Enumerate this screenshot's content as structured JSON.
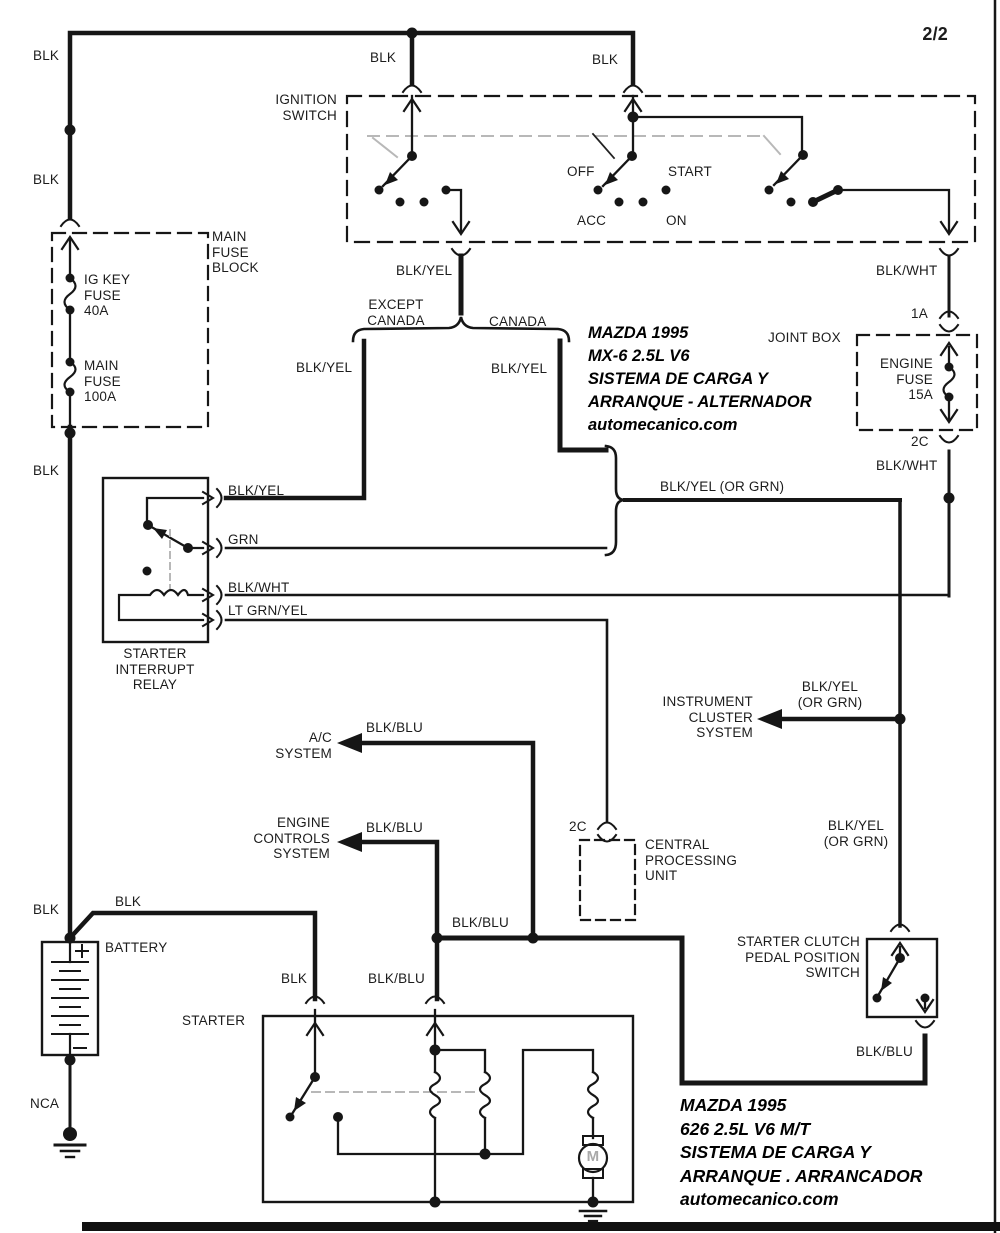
{
  "page": {
    "sheet": "2/2"
  },
  "blocks": {
    "ignition_switch": "IGNITION\nSWITCH",
    "main_fuse_block": "MAIN\nFUSE\nBLOCK",
    "ig_key_fuse": "IG KEY\nFUSE\n40A",
    "main_fuse": "MAIN\nFUSE\n100A",
    "joint_box": "JOINT BOX",
    "engine_fuse": "ENGINE\nFUSE\n15A",
    "starter_interrupt_relay": "STARTER\nINTERRUPT\nRELAY",
    "instrument_cluster_system": "INSTRUMENT\nCLUSTER\nSYSTEM",
    "ac_system": "A/C\nSYSTEM",
    "engine_controls_system": "ENGINE\nCONTROLS\nSYSTEM",
    "central_processing_unit": "CENTRAL\nPROCESSING\nUNIT",
    "battery": "BATTERY",
    "starter": "STARTER",
    "starter_clutch_switch": "STARTER CLUTCH\nPEDAL POSITION\nSWITCH",
    "motor_label": "M"
  },
  "ignition_positions": {
    "off": "OFF",
    "acc": "ACC",
    "start": "START",
    "on": "ON"
  },
  "connector_ids": {
    "c1a": "1A",
    "c2c_joint": "2C",
    "c2c_cpu": "2C"
  },
  "annotations": {
    "except_canada": "EXCEPT\nCANADA",
    "canada": "CANADA"
  },
  "wire_labels": {
    "blk_top_left": "BLK",
    "blk_left_upper": "BLK",
    "blk_left_lower": "BLK",
    "blk_left_bottom": "BLK",
    "blk_top_mid": "BLK",
    "blk_top_right": "BLK",
    "blk_yel_ignition": "BLK/YEL",
    "blk_wht_ignition": "BLK/WHT",
    "blk_yel_left_branch": "BLK/YEL",
    "blk_yel_right_branch": "BLK/YEL",
    "relay_pin_blk_yel": "BLK/YEL",
    "relay_pin_grn": "GRN",
    "relay_pin_blk_wht": "BLK/WHT",
    "relay_pin_lt_grn_yel": "LT GRN/YEL",
    "blk_yel_or_grn_main": "BLK/YEL (OR GRN)",
    "blk_wht_joint_lower": "BLK/WHT",
    "blk_yel_or_grn_cluster": "BLK/YEL\n(OR GRN)",
    "blk_yel_or_grn_switch": "BLK/YEL\n(OR GRN)",
    "blk_blu_ac": "BLK/BLU",
    "blk_blu_engine": "BLK/BLU",
    "blk_blu_bus": "BLK/BLU",
    "blk_blu_starter": "BLK/BLU",
    "blk_blu_clutch": "BLK/BLU",
    "blk_battery_feed": "BLK",
    "blk_battery_starter": "BLK",
    "nca": "NCA"
  },
  "title_block_top": {
    "line1": "MAZDA 1995",
    "line2": "MX-6  2.5L  V6",
    "line3": "SISTEMA DE CARGA Y",
    "line4": "ARRANQUE  - ALTERNADOR",
    "line5": "automecanico.com"
  },
  "title_block_bottom": {
    "line1": "MAZDA 1995",
    "line2": "626  2.5L  V6    M/T",
    "line3": "SISTEMA DE CARGA Y",
    "line4": "ARRANQUE . ARRANCADOR",
    "line5": "automecanico.com"
  },
  "colors": {
    "wire": "#161616",
    "background": "#ffffff",
    "linkage_gray": "#b8b8b8"
  }
}
